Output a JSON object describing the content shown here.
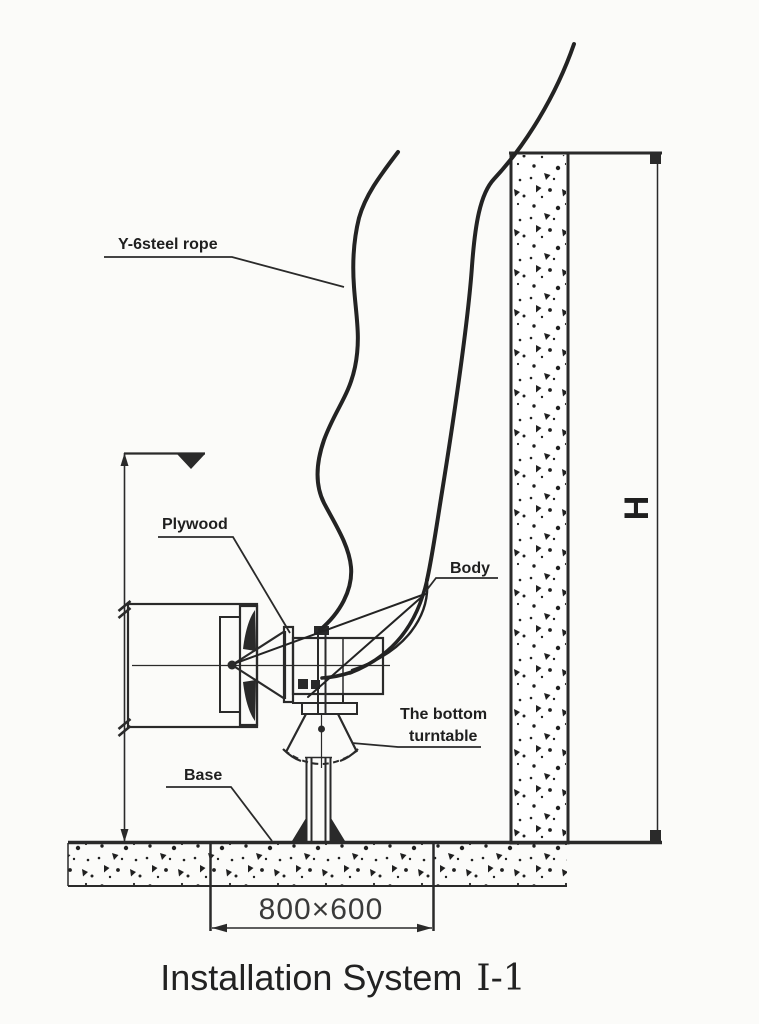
{
  "colors": {
    "background": "#fbfbf9",
    "ink": "#2a2a2a",
    "label_text": "#1f1f1f",
    "dimension_text": "#3a3a3a"
  },
  "diagram": {
    "part_labels": {
      "steel_rope": "Y-6steel rope",
      "plywood": "Plywood",
      "body": "Body",
      "turntable_line1": "The bottom",
      "turntable_line2": "turntable",
      "base": "Base"
    },
    "dimensions": {
      "wall_height": "H",
      "foundation_size": "800×600"
    },
    "title": {
      "main": "Installation System",
      "numeral": "Ⅰ-1"
    }
  }
}
